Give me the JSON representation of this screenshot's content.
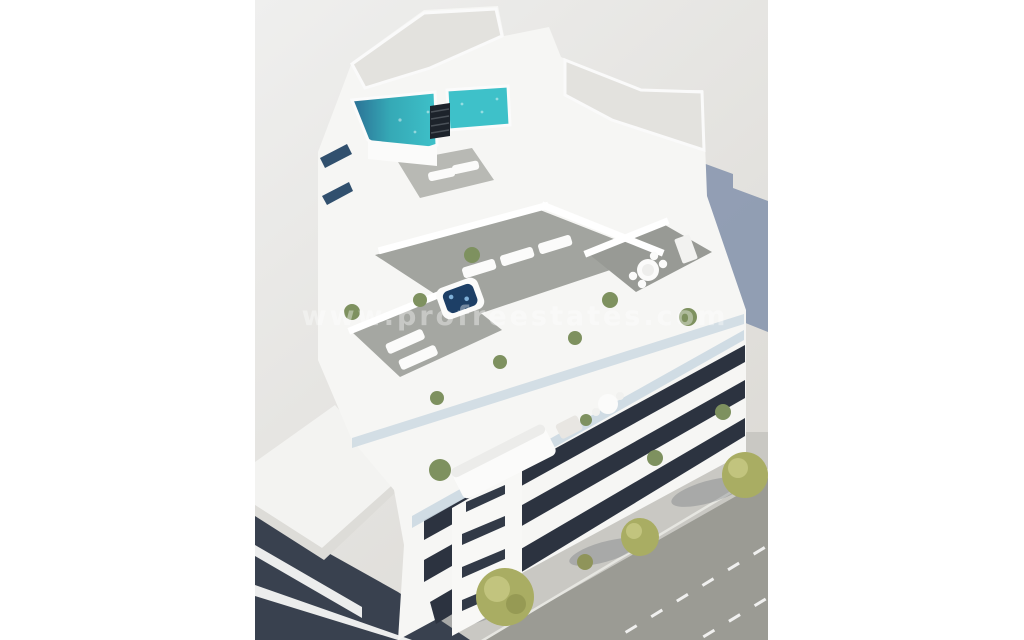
{
  "scene": {
    "kind": "3d-architectural-render",
    "subject": "aerial-view-modern-white-apartment-building-with-rooftop-pool-terraces-and-street",
    "watermark": "www.profreestates.com"
  },
  "colors": {
    "background_top": "#efefee",
    "background_bottom": "#dcdad5",
    "cast_shadow": "#7d8da9",
    "building_white": "#f6f6f4",
    "roof_concrete": "#e3e2de",
    "deck_wood": "#a2a49f",
    "deck_wood_light": "#b8b9b4",
    "pool_water": "#3ec1c9",
    "pool_deep": "#2b6f94",
    "hot_tub_water": "#1d3f66",
    "glass_dark": "#2c3340",
    "glass_slot": "#31506e",
    "balustrade_glass": "#ccd9e2",
    "neighbor_glass": "#39414f",
    "sidewalk": "#c9c8c3",
    "asphalt": "#9b9b94",
    "road_marking": "#ffffff",
    "tree_green": "#a9ad63",
    "tree_green_light": "#c2c47e",
    "shrub_green": "#7e915f",
    "furniture_white": "#fbfbfa"
  }
}
